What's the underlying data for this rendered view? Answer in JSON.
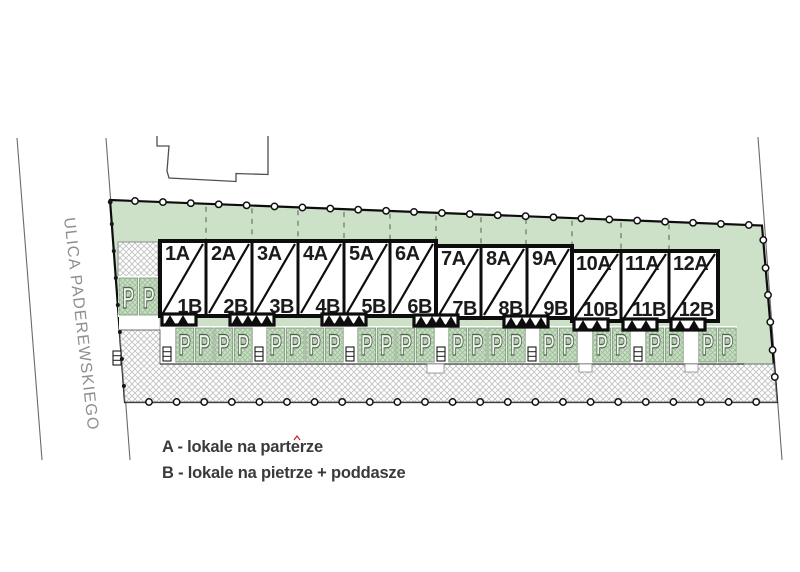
{
  "plan": {
    "street_name": "ULICA PADEREWSKIEGO",
    "legend": {
      "a": "A - lokale na parterze",
      "b": "B - lokale na pietrze + poddasze"
    },
    "parking_symbol": "P",
    "units": [
      {
        "a": "1A",
        "b": "1B"
      },
      {
        "a": "2A",
        "b": "2B"
      },
      {
        "a": "3A",
        "b": "3B"
      },
      {
        "a": "4A",
        "b": "4B"
      },
      {
        "a": "5A",
        "b": "5B"
      },
      {
        "a": "6A",
        "b": "6B"
      },
      {
        "a": "7A",
        "b": "7B"
      },
      {
        "a": "8A",
        "b": "8B"
      },
      {
        "a": "9A",
        "b": "9B"
      },
      {
        "a": "10A",
        "b": "10B"
      },
      {
        "a": "11A",
        "b": "11B"
      },
      {
        "a": "12A",
        "b": "12B"
      }
    ],
    "colors": {
      "parcel_green": "#cde0c8",
      "stall_green": "#c9dfc4",
      "stall_hatch": "#9fbf9a",
      "hatch_gray": "#c2c2c2",
      "line_black": "#0d0d0d",
      "text_dark": "#3a3a3a",
      "street_text": "#8f8f8f"
    }
  }
}
